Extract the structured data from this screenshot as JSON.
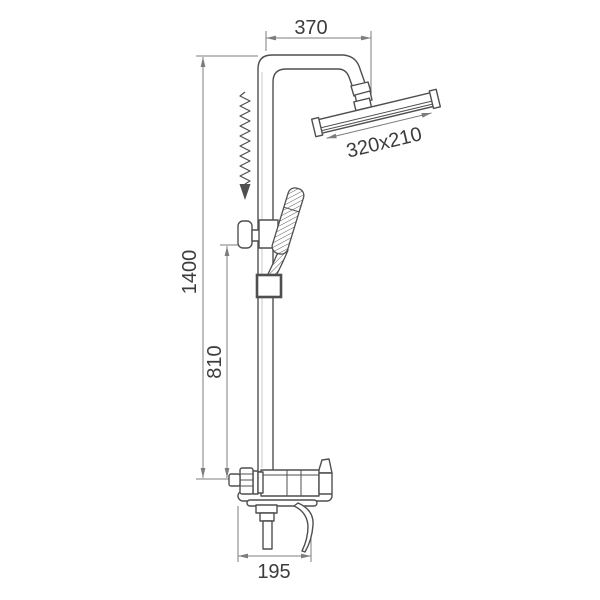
{
  "drawing": {
    "dimension_labels": {
      "top_width": "370",
      "head_size": "320x210",
      "total_height": "1400",
      "slider_height": "810",
      "base_width": "195"
    },
    "icons": {
      "slide_arrow": "zigzag-arrow-down"
    },
    "colors": {
      "background": "#ffffff",
      "outline": "#4f4f4f",
      "dimension": "#7d7d7d",
      "text": "#3c3c3c",
      "highlight": "#c9c9c9"
    }
  }
}
